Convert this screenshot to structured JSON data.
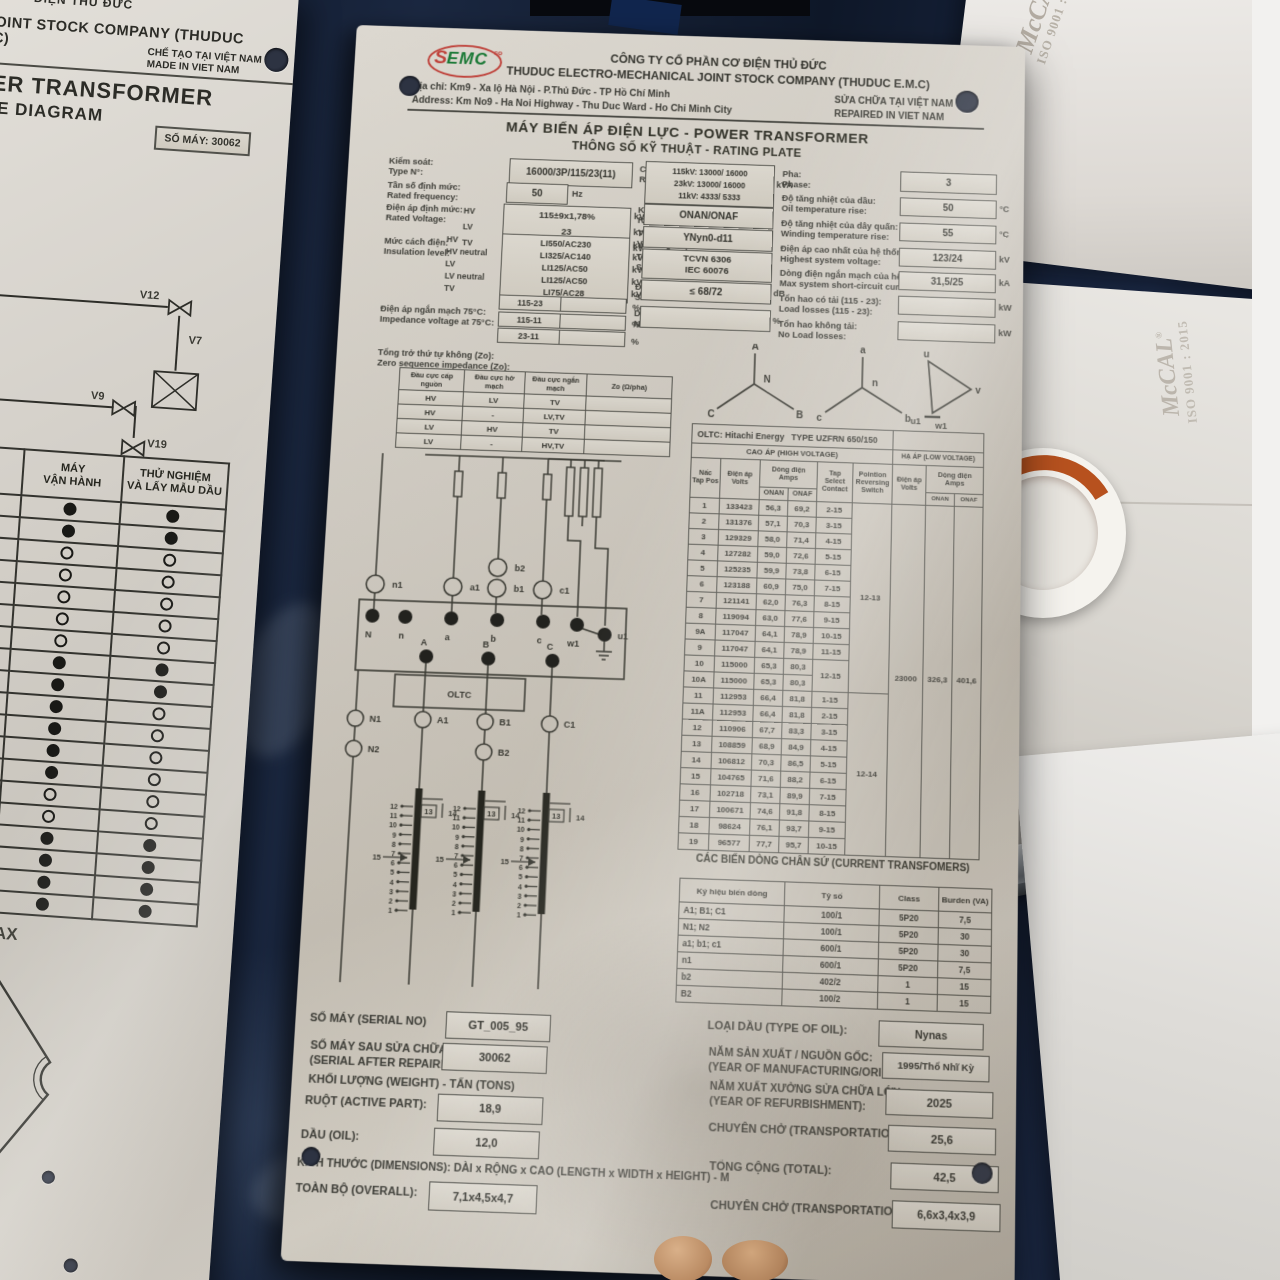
{
  "scene": {
    "watermark": {
      "brand": "McCAL",
      "reg": "®",
      "iso": "ISO 9001 : 2015"
    }
  },
  "left_plate": {
    "top_partial": "ĐIỆN THỦ ĐỨC",
    "company_partial": "AL JOINT STOCK COMPANY (THUDUC E.M.C)",
    "made_in": "CHẾ TẠO TẠI VIỆT NAM\nMADE IN VIET NAM",
    "title1": "OWER TRANSFORMER",
    "title2": "VALVE DIAGRAM",
    "serial": "SỐ MÁY: 30062",
    "valve_labels": [
      "V12",
      "V7",
      "V9",
      "V19",
      "LTC"
    ],
    "table": {
      "headers": [
        "NẠP DẦU",
        "MÁY\nVẬN HÀNH",
        "THỬ NGHIỆM\nVÀ LẤY MẪU DẦU"
      ],
      "rows": [
        [
          0,
          1,
          1
        ],
        [
          0,
          1,
          1
        ],
        [
          0,
          0,
          0
        ],
        [
          0,
          0,
          0
        ],
        [
          0,
          0,
          0
        ],
        [
          0,
          0,
          0
        ],
        [
          0,
          0,
          0
        ],
        [
          1,
          1,
          1
        ],
        [
          1,
          1,
          1
        ],
        [
          1,
          1,
          0
        ],
        [
          1,
          1,
          0
        ],
        [
          1,
          1,
          0
        ],
        [
          1,
          1,
          0
        ],
        [
          0,
          0,
          0
        ],
        [
          0,
          0,
          0
        ],
        [
          1,
          1,
          1
        ],
        [
          1,
          1,
          1
        ],
        [
          1,
          1,
          1
        ],
        [
          1,
          1,
          1
        ]
      ]
    },
    "gauge": {
      "max": "MAX",
      "min": "MIN",
      "ticks": [
        "9",
        "6",
        "1"
      ]
    }
  },
  "plate": {
    "header": {
      "logo": {
        "text": "EMC",
        "sub": "co",
        "sym": "S"
      },
      "company": "CÔNG TY CỔ PHẦN CƠ ĐIỆN THỦ ĐỨC\nTHUDUC ELECTRO-MECHANICAL JOINT STOCK COMPANY (THUDUC E.M.C)",
      "address": "Địa chỉ: Km9 - Xa lộ Hà Nội - P.Thủ Đức - TP Hồ Chí Minh\nAddress: Km No9 - Ha Noi Highway - Thu Duc Ward - Ho Chi Minh City",
      "repaired": "SỬA CHỮA TẠI VIỆT NAM\nREPAIRED IN VIET NAM"
    },
    "title": "MÁY BIẾN ÁP ĐIỆN LỰC - POWER TRANSFORMER",
    "subtitle": "THÔNG SỐ KỸ THUẬT - RATING PLATE",
    "specs": {
      "type_no": {
        "label": "Kiểm soát:\nType N°:",
        "value": "16000/3P/115/23(11)"
      },
      "frequency": {
        "label": "Tần số định mức:\nRated frequency:",
        "value": "50",
        "unit": "Hz"
      },
      "rated_voltage": {
        "label": "Điện áp định mức:\nRated Voltage:",
        "value": "115±9x1,78%\n23\n11",
        "rows": [
          {
            "w": "HV",
            "u": "kV"
          },
          {
            "w": "LV",
            "u": "kV"
          },
          {
            "w": "TV",
            "u": "kV"
          }
        ]
      },
      "insulation": {
        "label": "Mức cách điện:\nInsulation level:",
        "value": "LI550/AC230\nLI325/AC140\nLI125/AC50\nLI125/AC50\nLI75/AC28",
        "rows": [
          {
            "w": "HV",
            "u": "kV"
          },
          {
            "w": "HV neutral",
            "u": "kV"
          },
          {
            "w": "LV",
            "u": "kV"
          },
          {
            "w": "LV neutral",
            "u": "kV"
          },
          {
            "w": "TV",
            "u": "kV"
          }
        ]
      },
      "impedance": {
        "label": "Điện áp ngắn mạch 75°C:\nImpedance voltage at 75°C:",
        "rows": [
          "115-23",
          "115-11",
          "23-11"
        ],
        "unit": "%"
      },
      "zero_seq_label": "Tổng trở thứ tự không (Zo):\nZero sequence impedance (Zo):",
      "power": {
        "label": "Công suất:\nRated Power:",
        "value": "115kV: 13000/ 16000\n23kV: 13000/ 16000\n11kV: 4333/ 5333",
        "unit": "kVA"
      },
      "cooling": {
        "label": "Kiểu làm mát:\nRated Power:",
        "value": "ONAN/ONAF"
      },
      "vector_group": {
        "label": "Tổ đấu dây:\nVector group:",
        "value": "YNyn0-d11"
      },
      "standard": {
        "label": "Tiêu chuẩn:\nStandard:",
        "value": "TCVN 6306\nIEC 60076"
      },
      "sound": {
        "label": "Độ ồn:\nSound Level:",
        "value": "≤ 68/72",
        "unit": "dB"
      },
      "no_load_current": {
        "label": "Dòng không tải:\nNo load current:",
        "value": "",
        "unit": "%"
      },
      "phase": {
        "label": "Pha:\nPhase:",
        "value": "3",
        "unit": ""
      },
      "oil_rise": {
        "label": "Độ tăng nhiệt của dầu:\nOil temperature rise:",
        "value": "50",
        "unit": "°C"
      },
      "winding_rise": {
        "label": "Độ tăng nhiệt của dây quấn:\nWinding temperature rise:",
        "value": "55",
        "unit": "°C"
      },
      "highest_voltage": {
        "label": "Điện áp cao nhất của hệ thống:\nHighest system voltage:",
        "value": "123/24",
        "unit": "kV"
      },
      "short_circuit": {
        "label": "Dòng điện ngắn mạch của hệ thống:\nMax system short-circuit current:",
        "value": "31,5/25",
        "unit": "kA"
      },
      "load_losses": {
        "label": "Tổn hao có tải (115 - 23):\nLoad losses (115 - 23):",
        "value": "",
        "unit": "kW"
      },
      "no_load_losses": {
        "label": "Tổn hao không tải:\nNo Load losses:",
        "value": "",
        "unit": "kW"
      }
    },
    "zero_seq": {
      "headers": [
        "Đầu cực cấp nguồn",
        "Đầu cực hở mạch",
        "Đầu cực ngắn mạch",
        "Zo (Ω/pha)"
      ],
      "rows": [
        [
          "HV",
          "LV",
          "TV",
          ""
        ],
        [
          "HV",
          "-",
          "LV,TV",
          ""
        ],
        [
          "LV",
          "HV",
          "TV",
          ""
        ],
        [
          "LV",
          "-",
          "HV,TV",
          ""
        ]
      ]
    },
    "vectors": {
      "hv": {
        "top": "A",
        "center": "N",
        "left": "C",
        "right": "B"
      },
      "lv": {
        "top": "a",
        "center": "n",
        "left": "c",
        "right": "b"
      },
      "tv": {
        "top": "u",
        "right": "v",
        "bottom_left": "u1",
        "bottom": "w1"
      }
    },
    "oltc": {
      "title": "OLTC: Hitachi Energy",
      "type": "TYPE  UZFRN 650/150",
      "hv_head": "CAO ÁP (HIGH VOLTAGE)",
      "lv_head": "HẠ ÁP (LOW VOLTAGE)",
      "cols": {
        "tap": "Nấc\nTap Pos",
        "volts": "Điện áp\nVolts",
        "amps": "Dòng điện\nAmps",
        "onan": "ONAN",
        "onaf": "ONAF",
        "contact": "Tap\nSelect\nContact",
        "reversing": "Pointion\nReversing\nSwitch"
      },
      "rows": [
        [
          "1",
          "133423",
          "56,3",
          "69,2",
          "2-15"
        ],
        [
          "2",
          "131376",
          "57,1",
          "70,3",
          "3-15"
        ],
        [
          "3",
          "129329",
          "58,0",
          "71,4",
          "4-15"
        ],
        [
          "4",
          "127282",
          "59,0",
          "72,6",
          "5-15"
        ],
        [
          "5",
          "125235",
          "59,9",
          "73,8",
          "6-15"
        ],
        [
          "6",
          "123188",
          "60,9",
          "75,0",
          "7-15"
        ],
        [
          "7",
          "121141",
          "62,0",
          "76,3",
          "8-15"
        ],
        [
          "8",
          "119094",
          "63,0",
          "77,6",
          "9-15"
        ],
        [
          "9A",
          "117047",
          "64,1",
          "78,9",
          "10-15"
        ],
        [
          "9",
          "117047",
          "64,1",
          "78,9",
          "11-15"
        ],
        [
          "10",
          "115000",
          "65,3",
          "80,3",
          "12-15"
        ],
        [
          "10A",
          "115000",
          "65,3",
          "80,3",
          null
        ],
        [
          "11",
          "112953",
          "66,4",
          "81,8",
          "1-15"
        ],
        [
          "11A",
          "112953",
          "66,4",
          "81,8",
          "2-15"
        ],
        [
          "12",
          "110906",
          "67,7",
          "83,3",
          "3-15"
        ],
        [
          "13",
          "108859",
          "68,9",
          "84,9",
          "4-15"
        ],
        [
          "14",
          "106812",
          "70,3",
          "86,5",
          "5-15"
        ],
        [
          "15",
          "104765",
          "71,6",
          "88,2",
          "6-15"
        ],
        [
          "16",
          "102718",
          "73,1",
          "89,9",
          "7-15"
        ],
        [
          "17",
          "100671",
          "74,6",
          "91,8",
          "8-15"
        ],
        [
          "18",
          "98624",
          "76,1",
          "93,7",
          "9-15"
        ],
        [
          "19",
          "96577",
          "77,7",
          "95,7",
          "10-15"
        ]
      ],
      "reversing": [
        "12-13",
        "12-14"
      ],
      "merged_contact": "12-15",
      "lv": {
        "volts": "23000",
        "onan": "326,3",
        "onaf": "401,6"
      }
    },
    "schematic": {
      "top_cts": [
        "n1",
        "a1",
        "b1",
        "c1"
      ],
      "b2": "b2",
      "lv_terminals": [
        "N",
        "n",
        "a",
        "b",
        "c",
        "w1",
        "u1"
      ],
      "hv_terminals": [
        "A",
        "B",
        "C"
      ],
      "oltc_label": "OLTC",
      "lower_cts": [
        "N1",
        "N2",
        "A1",
        "B1",
        "B2",
        "C1"
      ],
      "tap_numbers": [
        "12",
        "11",
        "10",
        "9",
        "8",
        "7",
        "6",
        "5",
        "4",
        "3",
        "2",
        "1"
      ],
      "tap_top": [
        "13",
        "14"
      ],
      "tap_side": "15"
    },
    "ct": {
      "title": "CÁC BIẾN DÒNG CHÂN SỨ (CURRENT TRANSFOMERS)",
      "headers": [
        "Ký hiệu biến dòng",
        "Tỷ số",
        "Class",
        "Burden (VA)"
      ],
      "rows": [
        [
          "A1; B1; C1",
          "100/1",
          "5P20",
          "7,5"
        ],
        [
          "N1; N2",
          "100/1",
          "5P20",
          "30"
        ],
        [
          "a1; b1; c1",
          "600/1",
          "5P20",
          "30"
        ],
        [
          "n1",
          "600/1",
          "5P20",
          "7,5"
        ],
        [
          "b2",
          "402/2",
          "1",
          "15"
        ],
        [
          "B2",
          "100/2",
          "1",
          "15"
        ]
      ]
    },
    "footer_left": [
      {
        "label": "SỐ MÁY (SERIAL NO)",
        "value": "GT_005_95"
      },
      {
        "label": "SỐ MÁY SAU SỬA CHỮA)\n(SERIAL AFTER REPAIRING)",
        "value": "30062"
      },
      {
        "label": "KHỐI LƯỢNG (WEIGHT) - TẤN (TONS)",
        "value": ""
      },
      {
        "label": "RUỘT (ACTIVE PART):",
        "value": "18,9"
      },
      {
        "label": "DẦU (OIL):",
        "value": "12,0"
      },
      {
        "label": "KÍCH THƯỚC (DIMENSIONS): DÀI x RỘNG x CAO (LENGTH x WIDTH x HEIGHT) - M",
        "value": ""
      },
      {
        "label": "TOÀN BỘ (OVERALL):",
        "value": "7,1x4,5x4,7"
      }
    ],
    "footer_right": [
      {
        "label": "LOẠI DẦU (TYPE OF OIL):",
        "value": "Nynas"
      },
      {
        "label": "NĂM SẢN XUẤT / NGUỒN GỐC:\n(YEAR OF MANUFACTURING/ORIGIN):",
        "value": "1995/Thổ Nhĩ Kỳ"
      },
      {
        "label": "NĂM XUẤT XƯỞNG SỬA CHỮA LỚN:\n(YEAR OF REFURBISHMENT):",
        "value": "2025"
      },
      {
        "label": "CHUYÊN CHỞ (TRANSPORTATION):",
        "value": "25,6"
      },
      {
        "label": "TỔNG CỘNG (TOTAL):",
        "value": "42,5"
      },
      {
        "label": "CHUYÊN CHỞ (TRANSPORTATION):",
        "value": "6,6x3,4x3,9"
      }
    ]
  }
}
